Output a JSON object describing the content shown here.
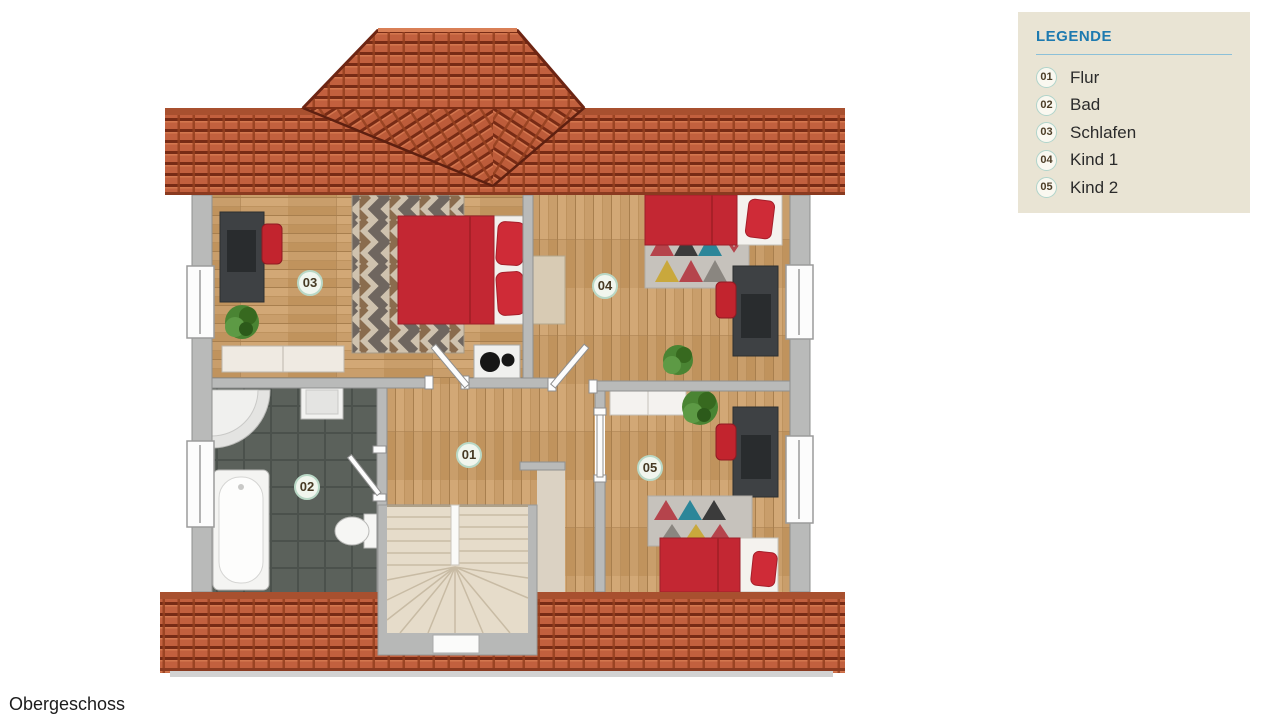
{
  "page": {
    "title": "Obergeschoss"
  },
  "legend": {
    "title": "LEGENDE",
    "items": [
      {
        "num": "01",
        "label": "Flur"
      },
      {
        "num": "02",
        "label": "Bad"
      },
      {
        "num": "03",
        "label": "Schlafen"
      },
      {
        "num": "04",
        "label": "Kind 1"
      },
      {
        "num": "05",
        "label": "Kind 2"
      }
    ]
  },
  "plan": {
    "badges": [
      "01",
      "02",
      "03",
      "04",
      "05"
    ]
  },
  "colors": {
    "roof_terracotta": "#c2603e",
    "roof_gap_dark": "#772b15",
    "wood_floor": "#c99e6b",
    "bath_tile": "#5b615b",
    "wall_gray": "#b9bab9",
    "stair_beige": "#e6dcca",
    "furniture_red": "#c32733",
    "desk_charcoal": "#3e4144",
    "legend_bg": "#e9e4d4",
    "legend_title_blue": "#1d7ab0",
    "badge_border_green": "#b9d8c6"
  }
}
